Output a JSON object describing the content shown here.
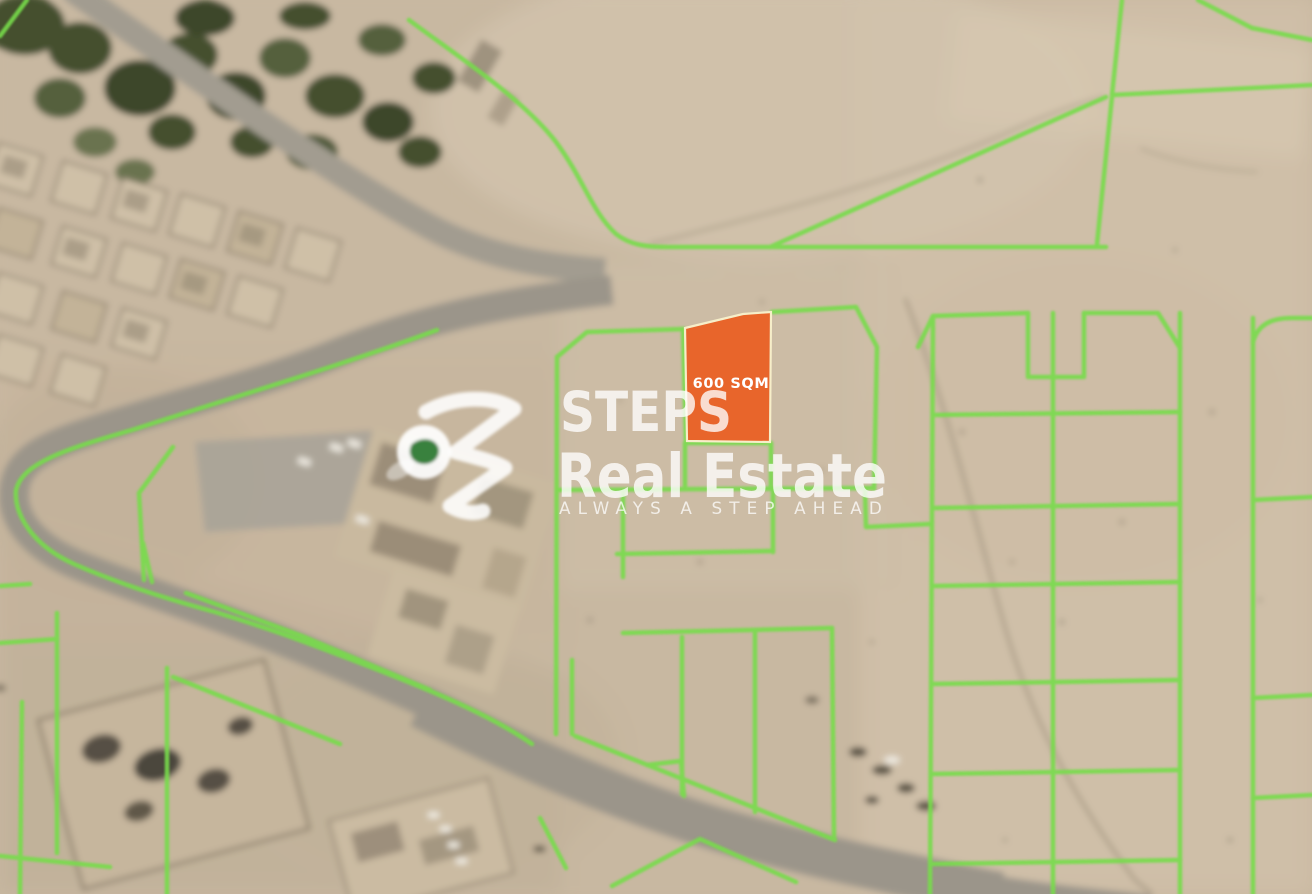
{
  "map": {
    "description": "Blurred satellite map of a desert land parcel area with green plot boundary overlays",
    "highlighted_plot": {
      "area_label": "600 SQM",
      "fill_color": "#E8652B",
      "border_color": "#F6EEC9",
      "label_color": "#FFFFFF"
    },
    "plot_boundary_color": "#77DC4B",
    "terrain_colors": {
      "sand": "#C9B9A2",
      "sand_light": "#D3C4AD",
      "sand_dark": "#BBAA92",
      "road": "#A29C90",
      "trees": "#45502F",
      "building": "#CFC0A7",
      "building_shadow": "#6E665A",
      "track": "#7E735F"
    }
  },
  "watermark": {
    "brand_name": "STEPS",
    "brand_suffix": "Real Estate",
    "tagline": "ALWAYS A STEP AHEAD",
    "text_color": "#FFFFFF",
    "logo_leaf_color": "#2F7A33"
  }
}
